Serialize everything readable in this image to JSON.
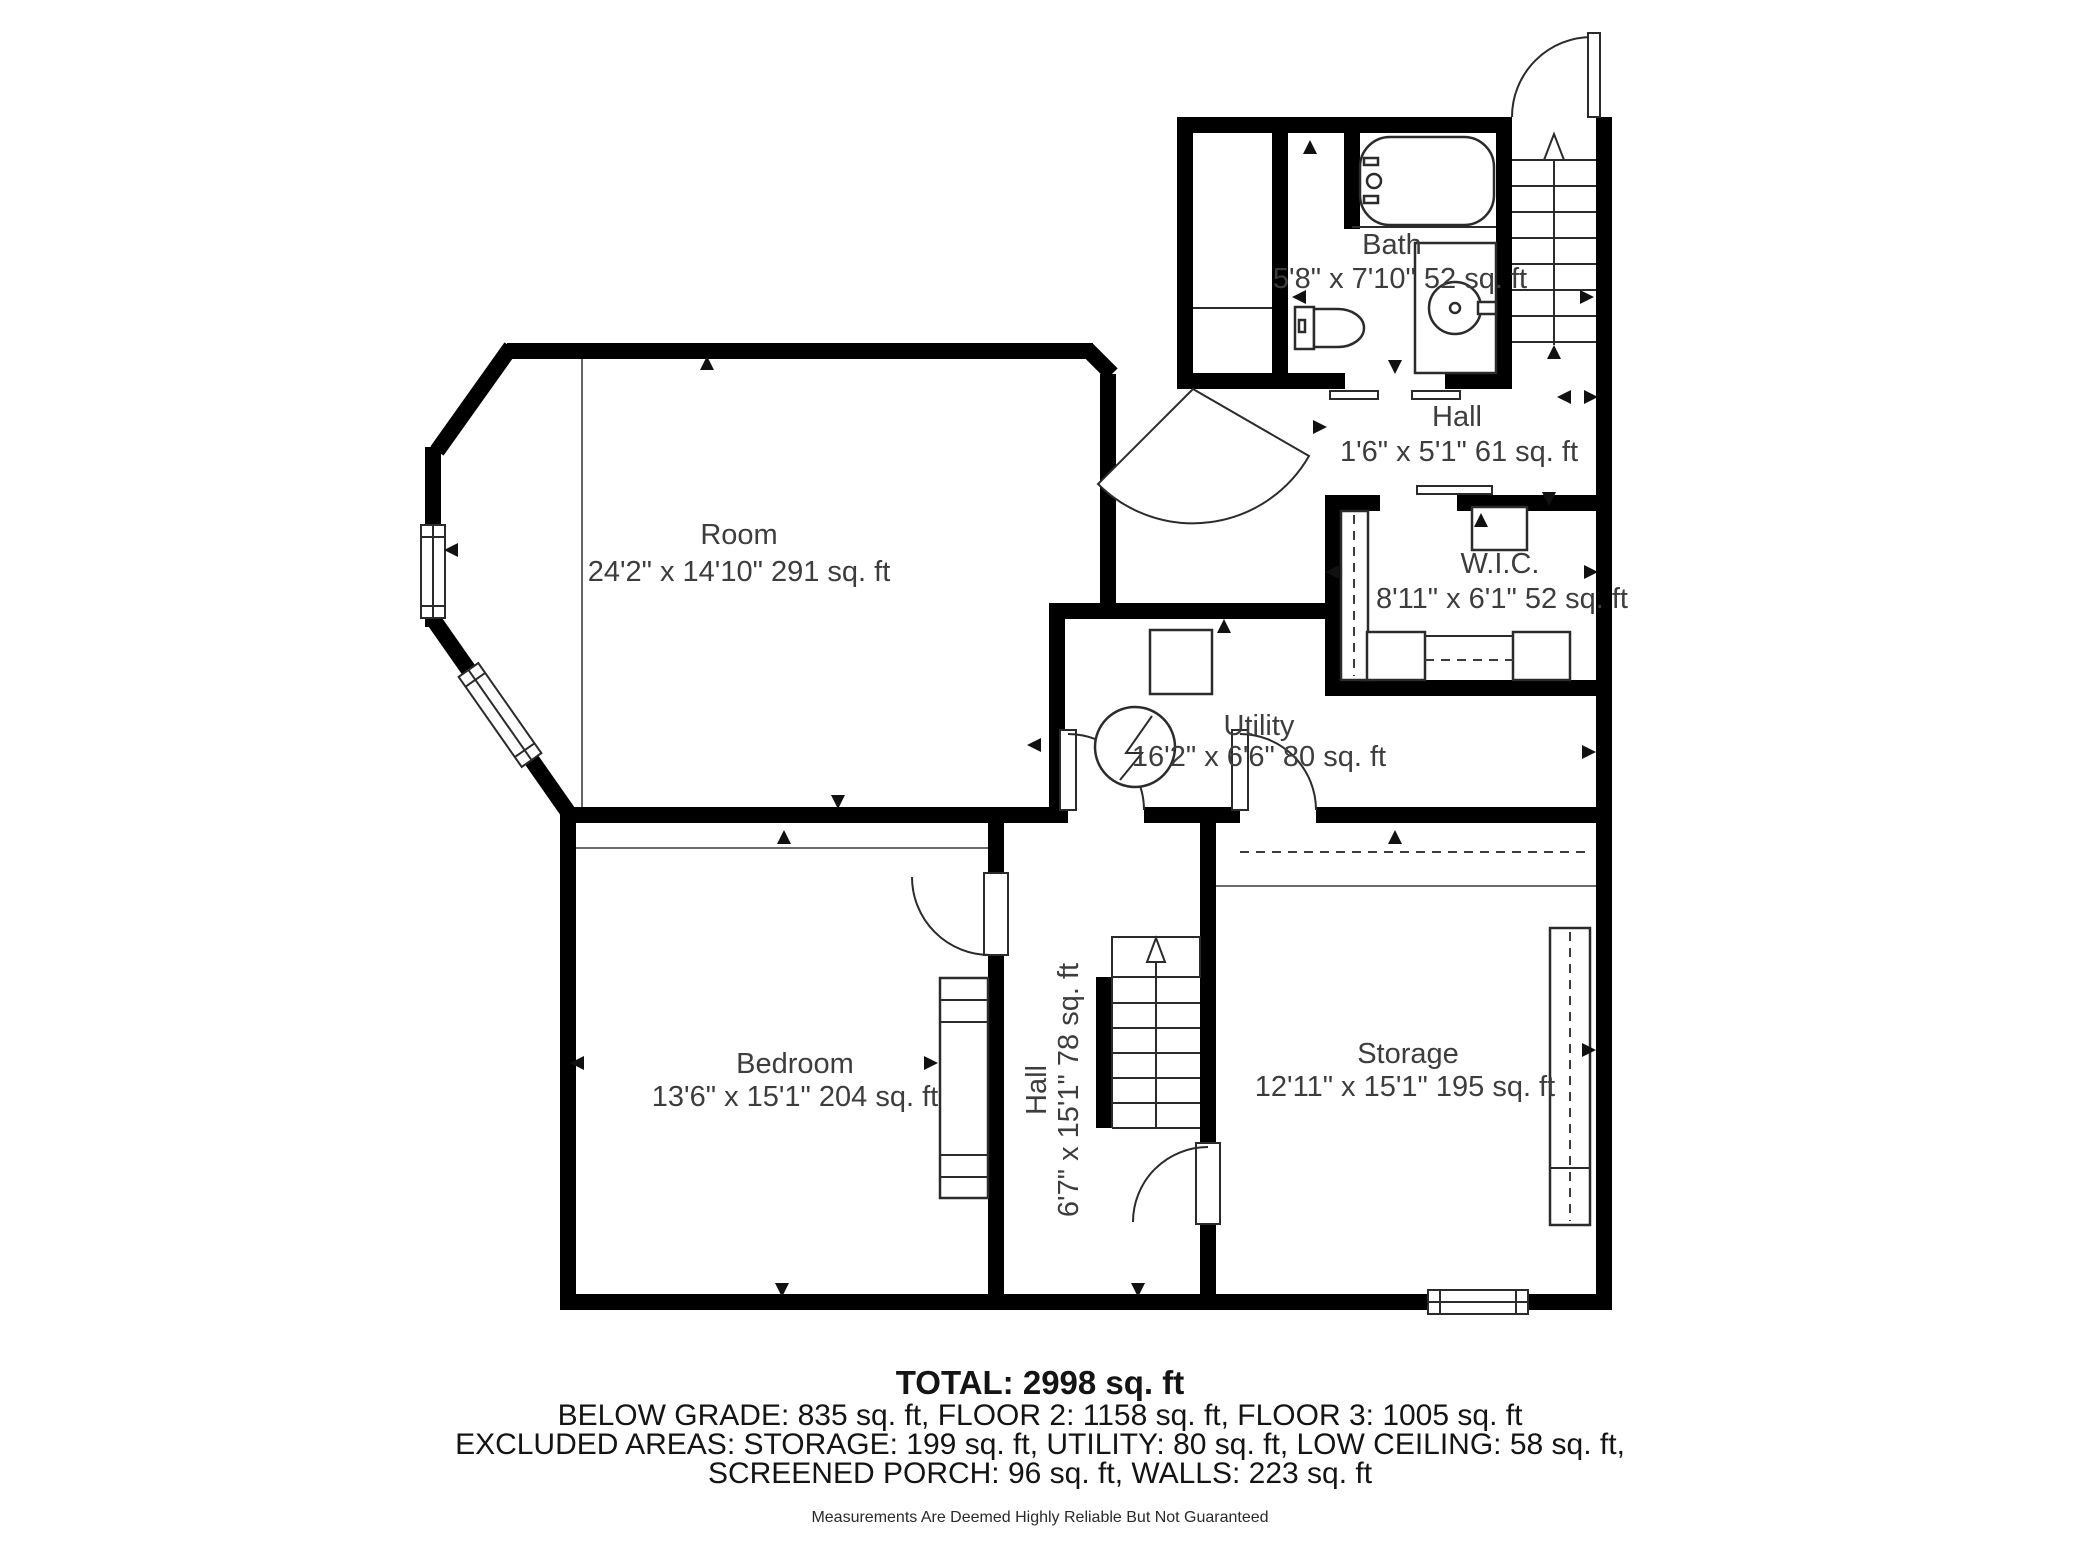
{
  "plan": {
    "rooms": [
      {
        "id": "room",
        "name": "Room",
        "dims": "24'2\" x 14'10\" 291 sq. ft"
      },
      {
        "id": "bath",
        "name": "Bath",
        "dims": "5'8\" x 7'10\" 52 sq. ft"
      },
      {
        "id": "hall-top",
        "name": "Hall",
        "dims": "1'6\" x 5'1\" 61 sq. ft"
      },
      {
        "id": "wic",
        "name": "W.I.C.",
        "dims": "8'11\" x 6'1\" 52 sq. ft"
      },
      {
        "id": "utility",
        "name": "Utility",
        "dims": "16'2\" x 6'6\" 80 sq. ft"
      },
      {
        "id": "bedroom",
        "name": "Bedroom",
        "dims": "13'6\" x 15'1\" 204 sq. ft"
      },
      {
        "id": "hall-bottom",
        "name": "Hall",
        "dims": "6'7\" x 15'1\" 78 sq. ft"
      },
      {
        "id": "storage",
        "name": "Storage",
        "dims": "12'11\" x 15'1\" 195 sq. ft"
      }
    ],
    "summary": {
      "total": "TOTAL: 2998 sq. ft",
      "line2": "BELOW GRADE: 835 sq. ft, FLOOR 2: 1158 sq. ft, FLOOR 3: 1005 sq. ft",
      "line3": "EXCLUDED AREAS: STORAGE: 199 sq. ft, UTILITY: 80 sq. ft, LOW CEILING: 58 sq. ft,",
      "line4": "SCREENED PORCH: 96 sq. ft, WALLS: 223 sq. ft",
      "disclaimer": "Measurements Are Deemed Highly Reliable But Not Guaranteed"
    },
    "colors": {
      "wall": "#000000",
      "text": "#3d3d3d"
    }
  }
}
